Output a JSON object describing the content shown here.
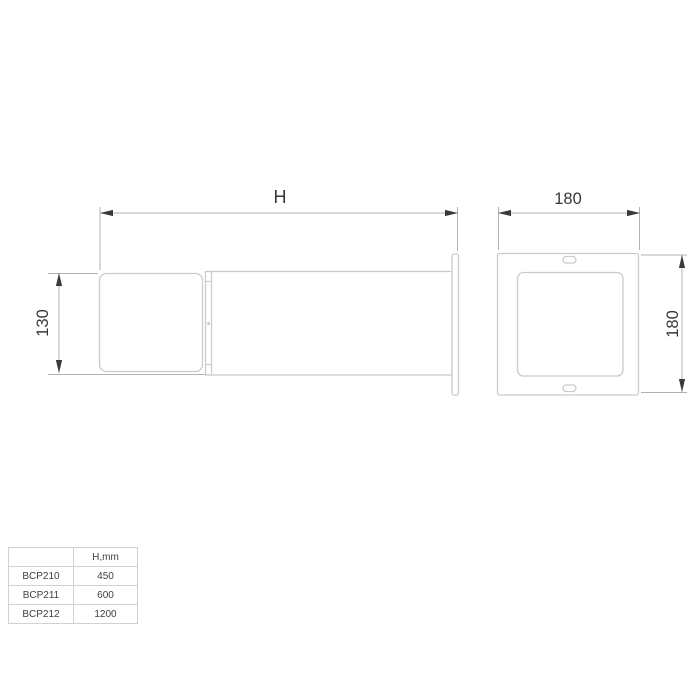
{
  "drawing": {
    "title": "Bollard luminaire dimension drawing",
    "colors": {
      "object_line": "#cbcbcb",
      "dimension_line": "#b2b2b2",
      "ink": "#3a3a3a",
      "background": "#ffffff"
    },
    "side_view": {
      "length_dim_label": "H",
      "head_height_dim_label": "130"
    },
    "front_view": {
      "width_dim_label": "180",
      "height_dim_label": "180"
    }
  },
  "spec_table": {
    "col_headers": [
      "",
      "H,mm"
    ],
    "rows": [
      {
        "model": "BCP210",
        "h": "450"
      },
      {
        "model": "BCP211",
        "h": "600"
      },
      {
        "model": "BCP212",
        "h": "1200"
      }
    ]
  }
}
